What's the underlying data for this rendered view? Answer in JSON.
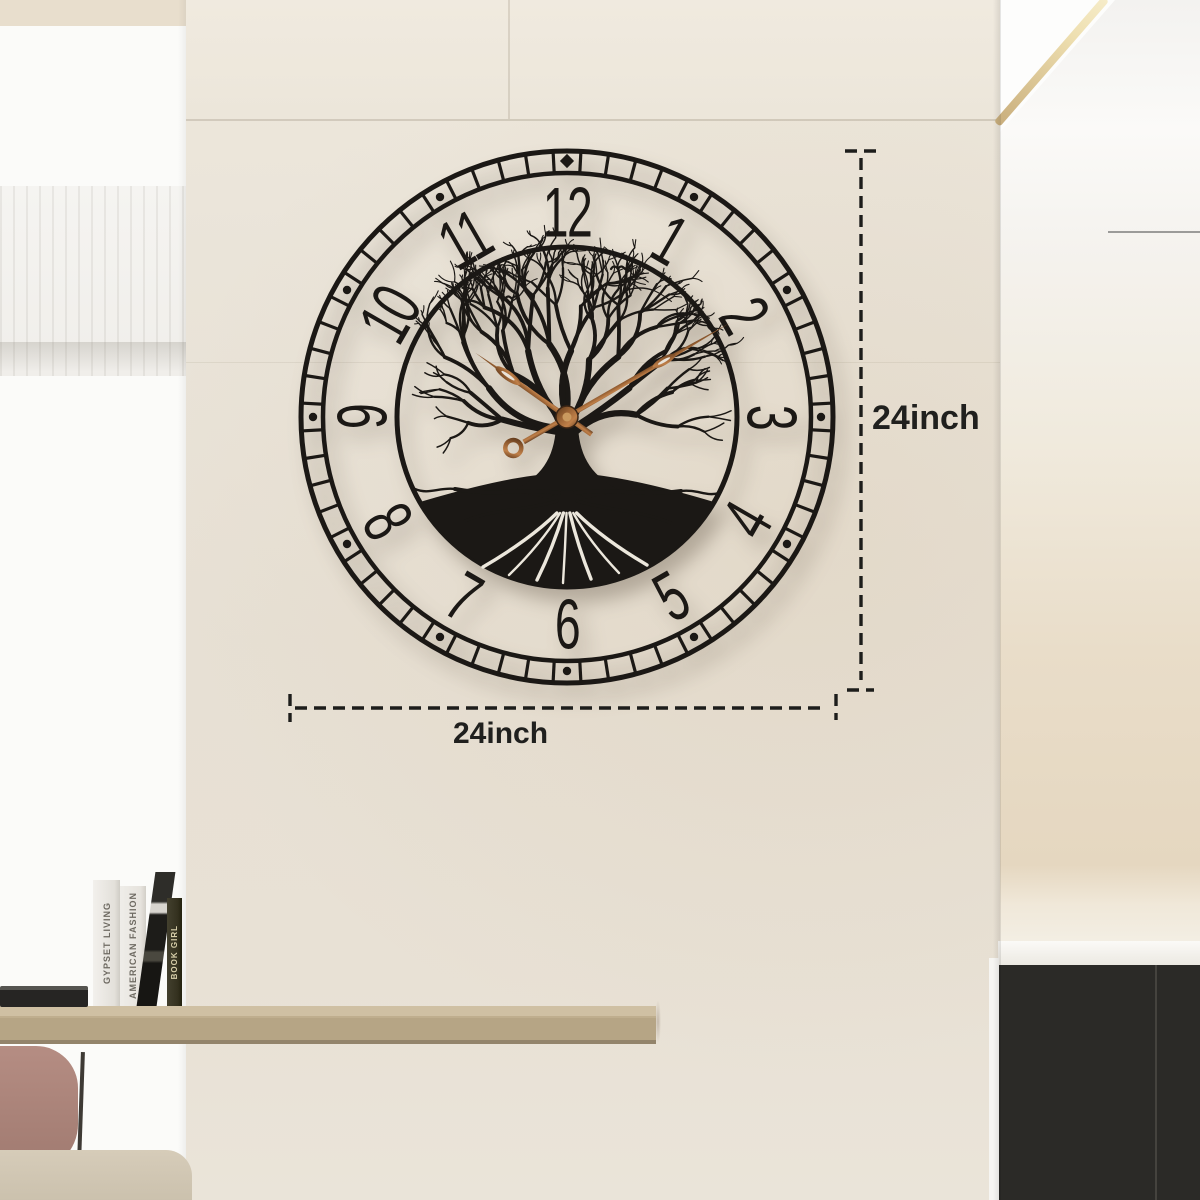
{
  "annotation": {
    "height_label": "24inch",
    "width_label": "24inch"
  },
  "clock": {
    "numerals": [
      "1",
      "2",
      "3",
      "4",
      "5",
      "6",
      "7",
      "8",
      "9",
      "10",
      "11",
      "12"
    ],
    "time_shown": "10:10",
    "frame_color": "#1b1815",
    "hands_color": "#8a5a33",
    "style": "tree-of-life-skeleton-dial"
  },
  "books": [
    {
      "title": "GYPSET LIVING"
    },
    {
      "title": "AMERICAN FASHION"
    },
    {
      "title": ""
    },
    {
      "title": "BOOK GIRL"
    }
  ],
  "colors": {
    "wall": "#e9e3d9",
    "window_wall": "#fbfbf9",
    "counter_wood": "#b6a585",
    "cabinet": "#2b2a27",
    "annotation_ink": "#1d1d1b",
    "copper_hands": "#9a6234"
  }
}
